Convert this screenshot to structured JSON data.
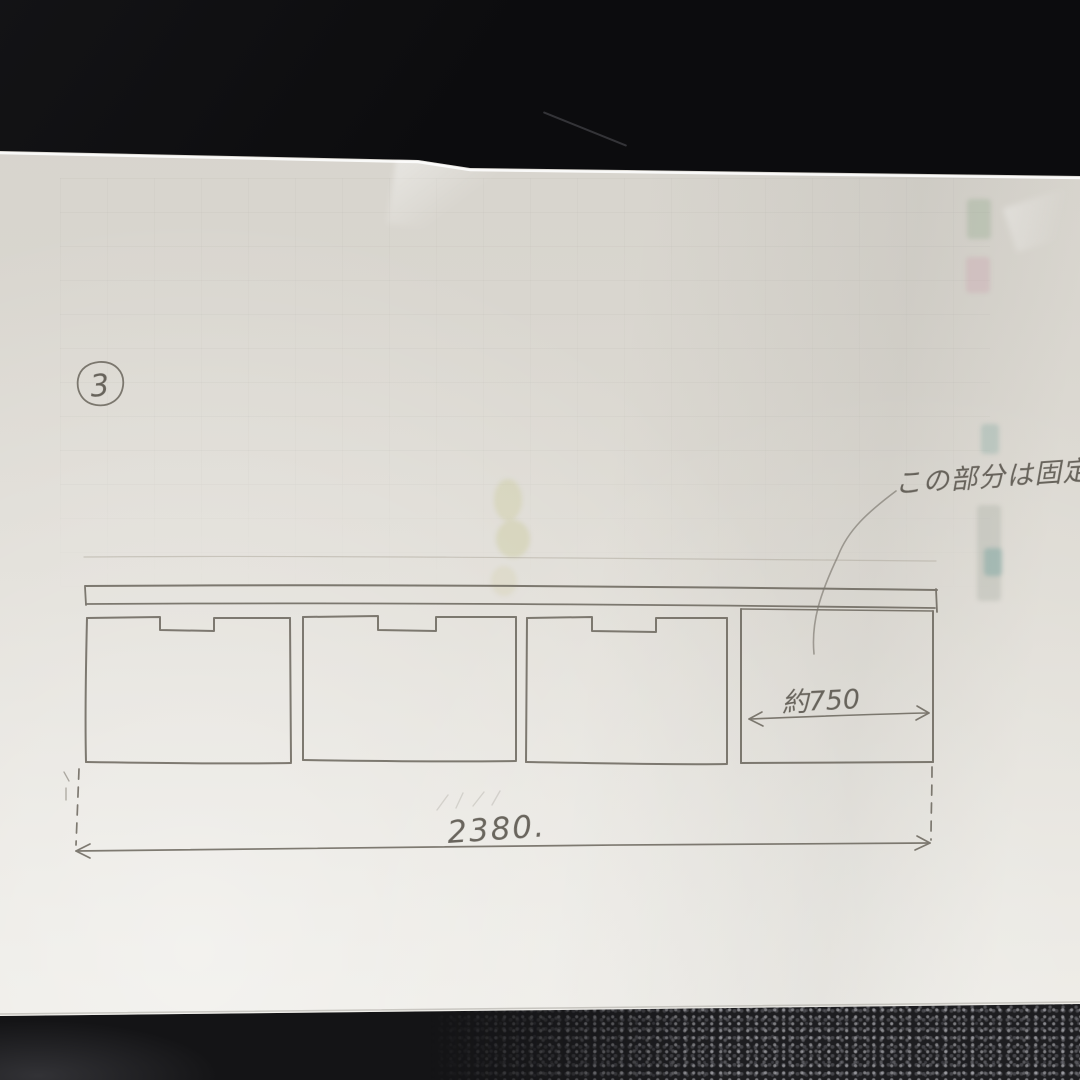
{
  "sketch": {
    "page_number": "3",
    "annotation": "この部分は固定",
    "dim_right_section": "約750",
    "dim_total_width": "2380."
  },
  "colors": {
    "paper": "#e3e0d9",
    "background_surface": "#0c0c0e",
    "pencil": "#5f5a52"
  }
}
